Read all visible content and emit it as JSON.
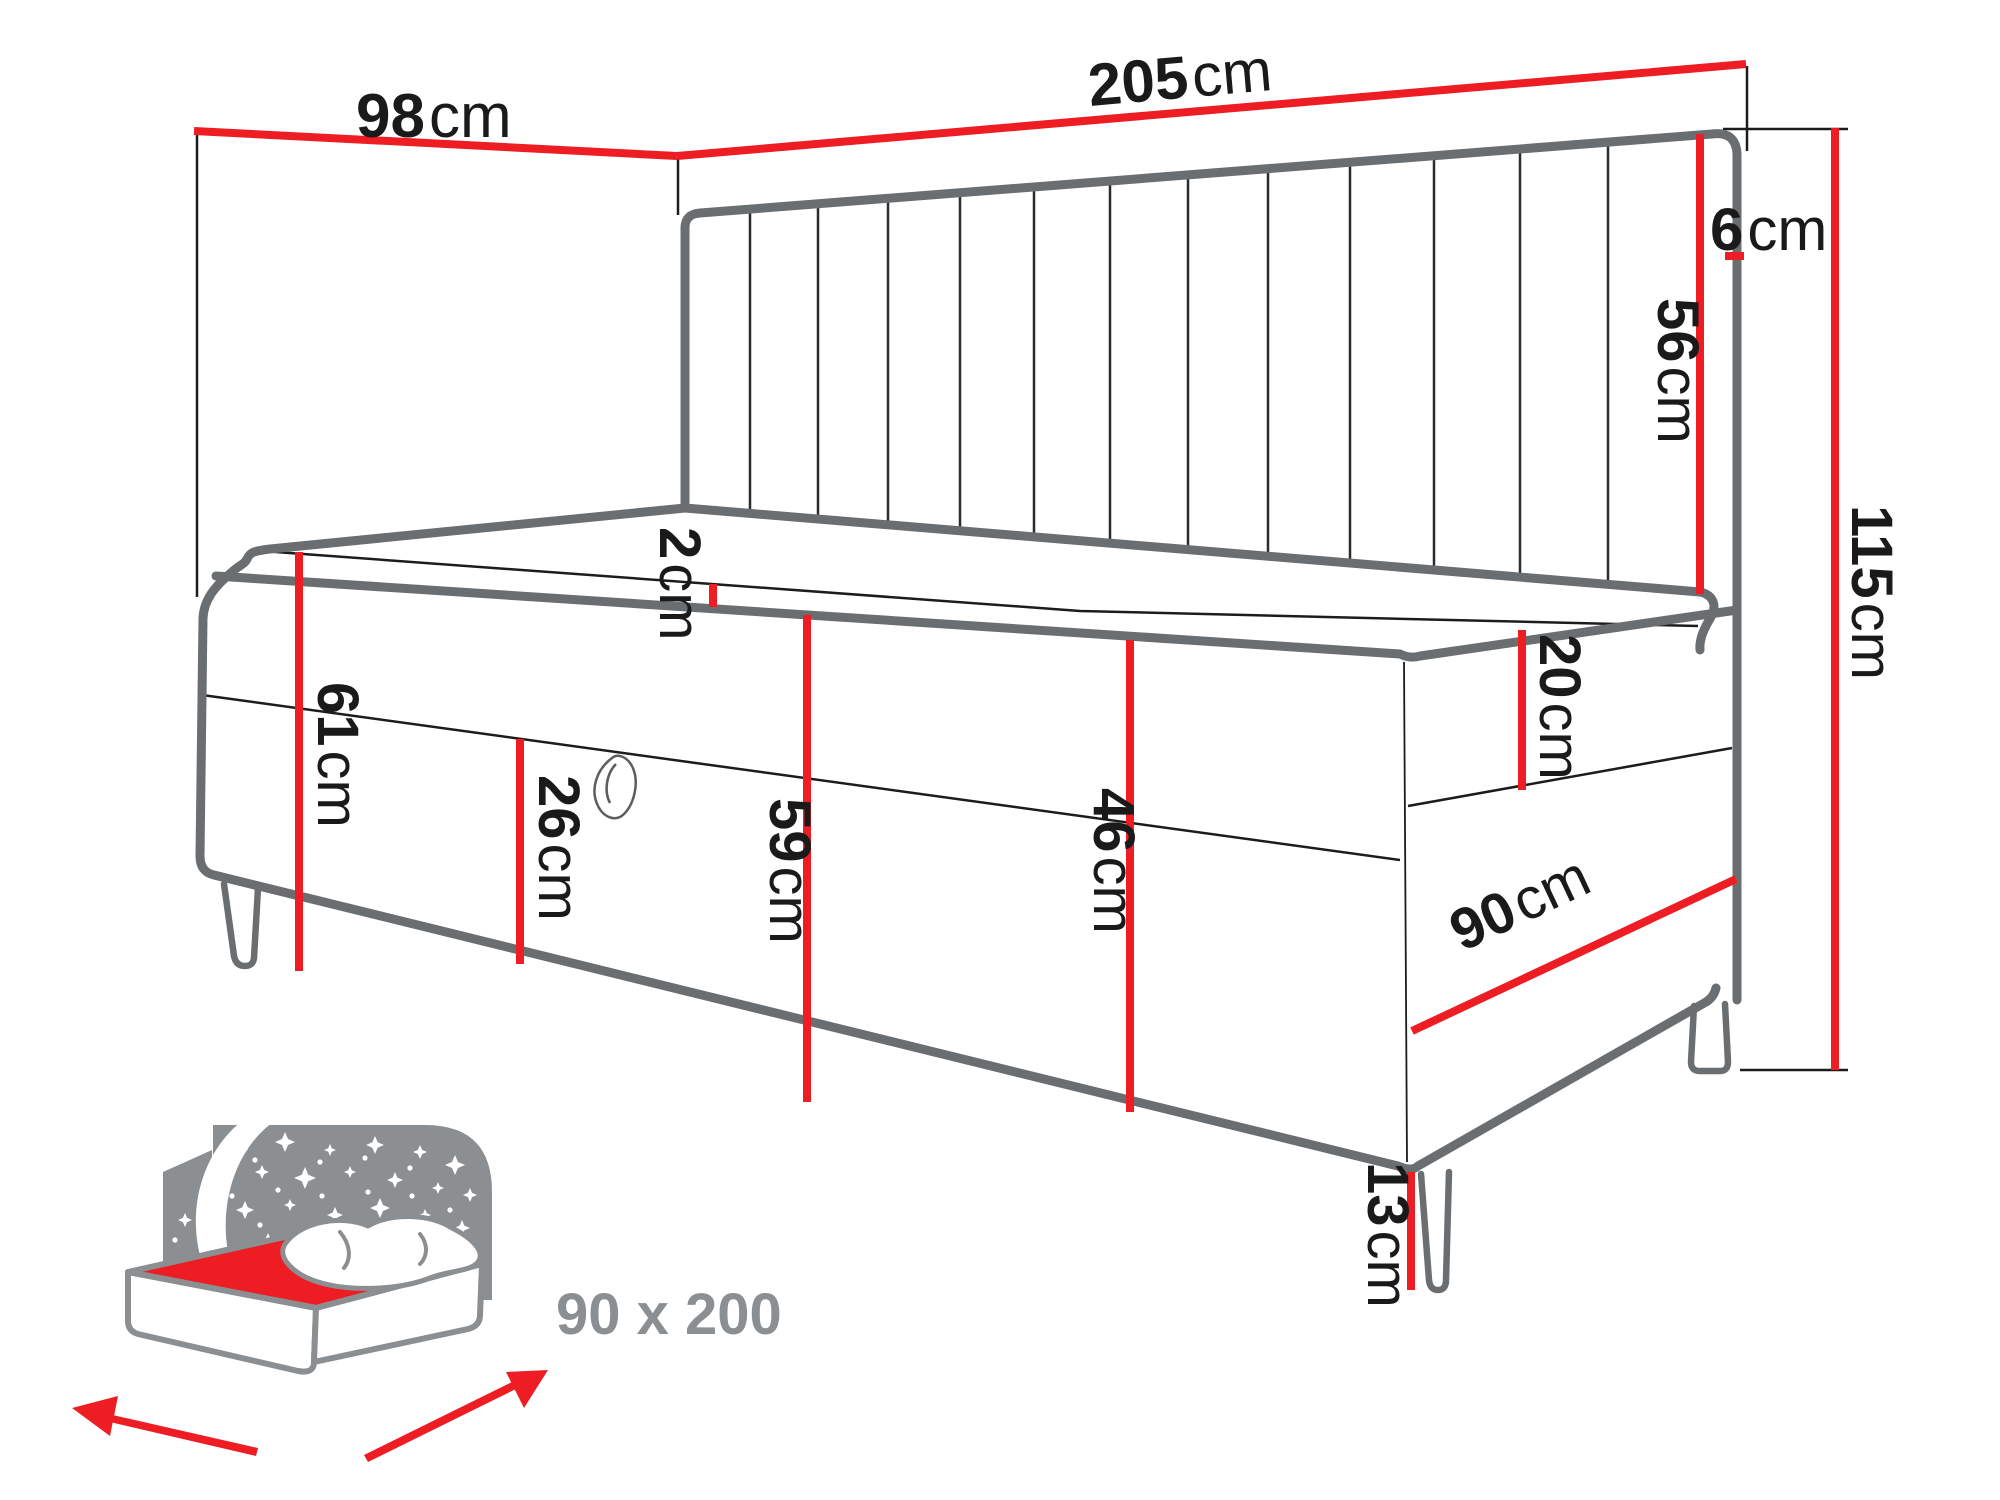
{
  "diagram": {
    "type": "furniture-dimension-diagram",
    "subject": "upholstered daybed with channel-tufted corner headboard, storage base and legs"
  },
  "dims": {
    "d98": {
      "num": "98",
      "unit": "cm"
    },
    "d205": {
      "num": "205",
      "unit": "cm"
    },
    "d6": {
      "num": "6",
      "unit": "cm"
    },
    "d56": {
      "num": "56",
      "unit": "cm"
    },
    "d115": {
      "num": "115",
      "unit": "cm"
    },
    "d2": {
      "num": "2",
      "unit": "cm"
    },
    "d61": {
      "num": "61",
      "unit": "cm"
    },
    "d26": {
      "num": "26",
      "unit": "cm"
    },
    "d59": {
      "num": "59",
      "unit": "cm"
    },
    "d46": {
      "num": "46",
      "unit": "cm"
    },
    "d20": {
      "num": "20",
      "unit": "cm"
    },
    "d90": {
      "num": "90",
      "unit": "cm"
    },
    "d13": {
      "num": "13",
      "unit": "cm"
    }
  },
  "size_label": "90 x 200",
  "colors": {
    "dimension_red": "#ee1c23",
    "outline_gray": "#6a6e70",
    "line_black": "#1c1c1c",
    "icon_gray": "#8b8f91",
    "label_black": "#1a1a1a"
  }
}
